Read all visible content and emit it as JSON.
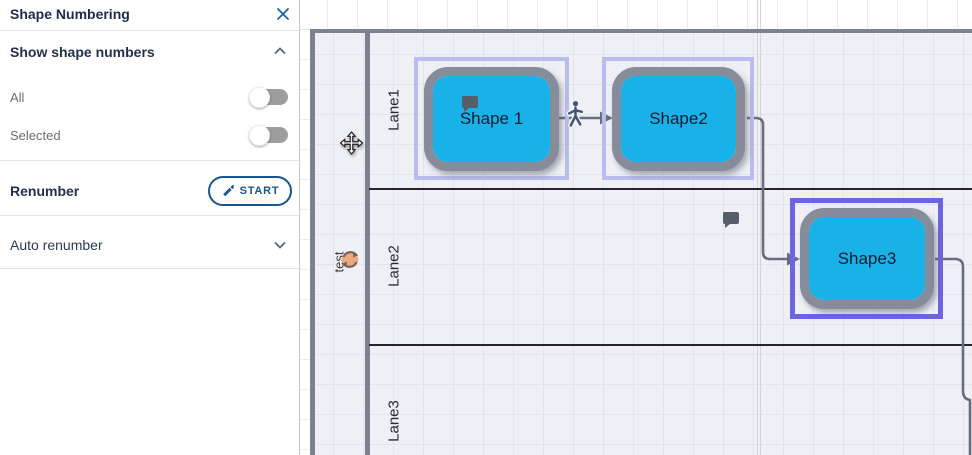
{
  "panel": {
    "title": "Shape Numbering",
    "show_section": {
      "label": "Show shape numbers",
      "state": "expanded",
      "items": [
        {
          "label": "All",
          "toggle_state": "off"
        },
        {
          "label": "Selected",
          "toggle_state": "off"
        }
      ]
    },
    "renumber_section": {
      "label": "Renumber",
      "button_label": "START"
    },
    "auto_section": {
      "label": "Auto renumber",
      "state": "collapsed"
    }
  },
  "canvas": {
    "pool": {
      "title": "test",
      "lanes": [
        {
          "label": "Lane1"
        },
        {
          "label": "Lane2"
        },
        {
          "label": "Lane3"
        }
      ]
    },
    "shapes": [
      {
        "label": "Shape 1",
        "lane": "Lane1",
        "selected": true,
        "has_comment_icon": true
      },
      {
        "label": "Shape2",
        "lane": "Lane1",
        "selected": true,
        "has_comment_icon": false
      },
      {
        "label": "Shape3",
        "lane": "Lane2",
        "selected": true,
        "has_comment_icon": false
      }
    ],
    "connectors": [
      {
        "from": "Shape 1",
        "to": "Shape2",
        "marker": "person-icon"
      },
      {
        "from": "Shape2",
        "to": "Shape3"
      },
      {
        "from": "Shape3",
        "to": "offscreen-right"
      }
    ],
    "icons": [
      "comment-icon",
      "person-icon",
      "sync-badge-icon",
      "move-cursor-icon"
    ]
  },
  "colors": {
    "accent_blue": "#17568f",
    "close_blue": "#1566ad",
    "shape_fill": "#18b1e8",
    "shape_border": "#868c9a",
    "selection_light": "#b8bcee",
    "selection_dark": "#6e64e3",
    "pool_border": "#7b8191",
    "pool_fill": "#eef0f6",
    "toggle_off": "#9d9d9d",
    "connector": "#666d7d",
    "sync_badge": "#efa87e"
  }
}
